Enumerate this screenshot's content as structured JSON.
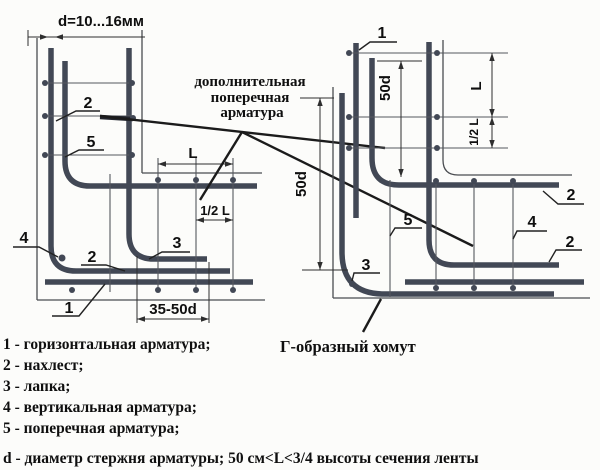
{
  "drawing_title": "Армирование угла ленточного фундамента (схема)",
  "colors": {
    "rebar": "#424855",
    "line": "#2e2e2e",
    "background": "#fcfcfa",
    "text": "#0f0f0f"
  },
  "top_dim": "d=10...16мм",
  "note": {
    "line1": "дополнительная",
    "line2": "поперечная",
    "line3": "арматура"
  },
  "clamp": "Г-образный хомут",
  "dims": {
    "L": "L",
    "half_L": "1/2 L",
    "l3550": "35-50d",
    "d50": "50d"
  },
  "nums": {
    "n1": "1",
    "n2": "2",
    "n3": "3",
    "n4": "4",
    "n5": "5"
  },
  "legend": {
    "items": [
      "1 - горизонтальная арматура;",
      "2 - нахлест;",
      "3 - лапка;",
      "4 - вертикальная арматура;",
      "5 - поперечная арматура;"
    ],
    "footnote": "d - диаметр стержня арматуры; 50 см<L<3/4 высоты сечения ленты"
  }
}
